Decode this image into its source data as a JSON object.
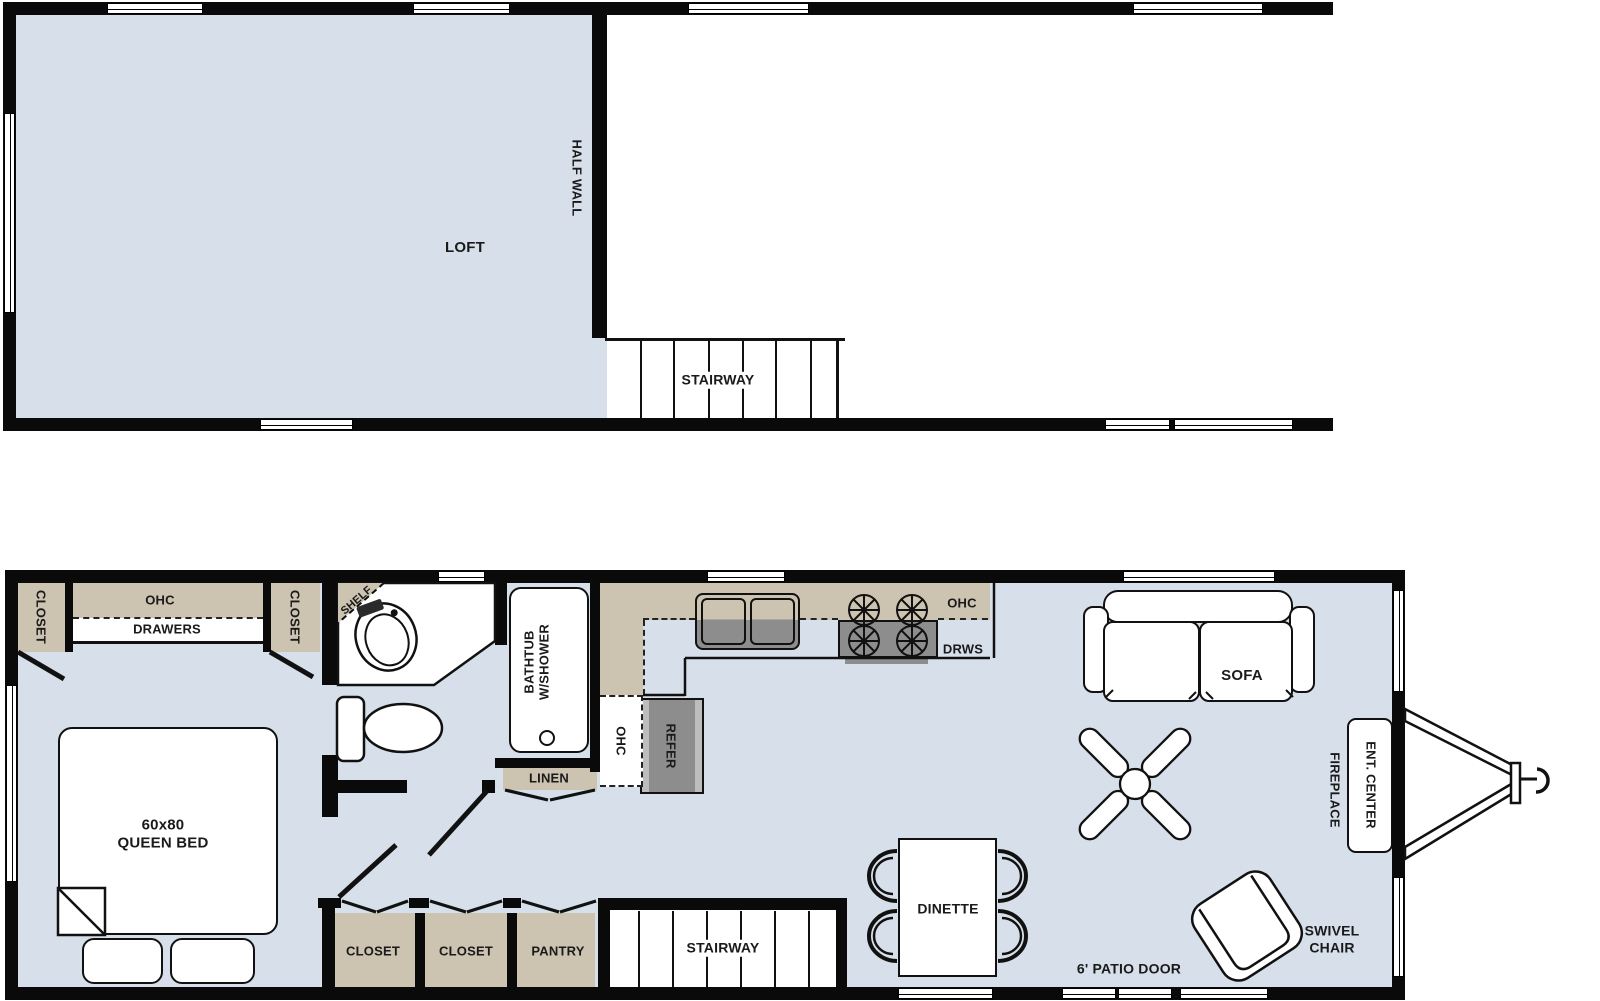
{
  "colors": {
    "floor": "#d7e0ea",
    "cabinet": "#cdc3b1",
    "appliance": "#8d8d8d",
    "rail": "#bdbdbd",
    "wall": "#0a0a0a",
    "ink": "#1a1a1a",
    "paper": "#ffffff"
  },
  "loft_plan": {
    "room": "LOFT",
    "half_wall": "HALF WALL",
    "stairway": "STAIRWAY"
  },
  "main_plan": {
    "bedroom": {
      "closet_left": "CLOSET",
      "ohc": "OHC",
      "drawers": "DRAWERS",
      "closet_right": "CLOSET",
      "bed_size": "60x80",
      "bed_type": "QUEEN BED"
    },
    "bath": {
      "shelf": "SHELF",
      "tub_line1": "BATHTUB",
      "tub_line2": "W/SHOWER",
      "linen": "LINEN"
    },
    "kitchen": {
      "ohc_tall": "OHC",
      "refer": "REFER",
      "ohc": "OHC",
      "drws": "DRWS"
    },
    "hall": {
      "closet_a": "CLOSET",
      "closet_b": "CLOSET",
      "pantry": "PANTRY",
      "stairway": "STAIRWAY"
    },
    "living": {
      "sofa": "SOFA",
      "dinette": "DINETTE",
      "patio_door": "6' PATIO DOOR",
      "swivel_line1": "SWIVEL",
      "swivel_line2": "CHAIR",
      "ent_center": "ENT. CENTER",
      "fireplace": "FIREPLACE"
    }
  }
}
